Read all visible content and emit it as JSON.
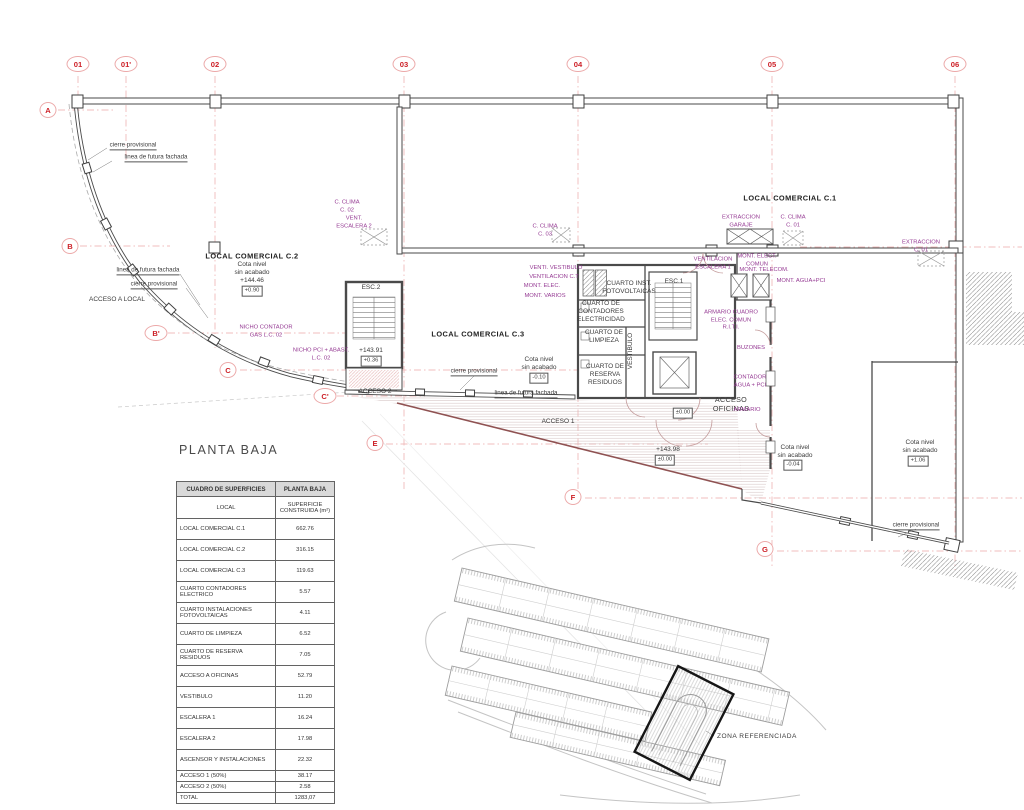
{
  "title": "PLANTA BAJA",
  "colors": {
    "marker_red": "#cd2027",
    "annotation_purple": "#953a93",
    "wall_gray": "#4a4a4a",
    "grid_pink": "#f0bcbc",
    "facade_diagonal": "#8f5252"
  },
  "grid": {
    "top_markers": [
      {
        "label": "01",
        "x": 78,
        "y": 64
      },
      {
        "label": "01'",
        "x": 126,
        "y": 64
      },
      {
        "label": "02",
        "x": 215,
        "y": 64
      },
      {
        "label": "03",
        "x": 404,
        "y": 64
      },
      {
        "label": "04",
        "x": 578,
        "y": 64
      },
      {
        "label": "05",
        "x": 772,
        "y": 64
      },
      {
        "label": "06",
        "x": 955,
        "y": 64
      }
    ],
    "side_markers": [
      {
        "label": "A",
        "x": 48,
        "y": 110
      },
      {
        "label": "B",
        "x": 70,
        "y": 246
      },
      {
        "label": "B'",
        "x": 156,
        "y": 333
      },
      {
        "label": "C",
        "x": 228,
        "y": 370
      },
      {
        "label": "C'",
        "x": 325,
        "y": 396
      },
      {
        "label": "E",
        "x": 375,
        "y": 443
      },
      {
        "label": "F",
        "x": 573,
        "y": 497
      },
      {
        "label": "G",
        "x": 765,
        "y": 549
      }
    ]
  },
  "plan": {
    "labels": [
      {
        "t": "cierre provisional",
        "x": 133,
        "y": 146,
        "k": "u"
      },
      {
        "t": "linea de futura fachada",
        "x": 156,
        "y": 158,
        "k": "u"
      },
      {
        "t": "LOCAL COMERCIAL C.2",
        "x": 252,
        "y": 256,
        "k": "B"
      },
      {
        "t": "Cota nivel\nsin acabado\n+144.46",
        "x": 252,
        "y": 273,
        "k": "b"
      },
      {
        "t": "+0.90",
        "x": 252,
        "y": 291,
        "k": "x"
      },
      {
        "t": "linea de futura fachada",
        "x": 148,
        "y": 271,
        "k": "u"
      },
      {
        "t": "cierre provisional",
        "x": 154,
        "y": 285,
        "k": "u"
      },
      {
        "t": "ACCESO A LOCAL",
        "x": 117,
        "y": 300,
        "k": "b"
      },
      {
        "t": "NICHO CONTADOR\nGAS L.C. 02",
        "x": 266,
        "y": 332,
        "k": "p"
      },
      {
        "t": "NICHO PCI + ABAST.\nL.C. 02",
        "x": 321,
        "y": 355,
        "k": "p"
      },
      {
        "t": "ESC.2",
        "x": 371,
        "y": 288,
        "k": "b"
      },
      {
        "t": "+143.91",
        "x": 371,
        "y": 351,
        "k": "b"
      },
      {
        "t": "+0.36",
        "x": 371,
        "y": 361,
        "k": "x"
      },
      {
        "t": "ACCESO 2",
        "x": 375,
        "y": 392,
        "k": "b"
      },
      {
        "t": "LOCAL COMERCIAL C.3",
        "x": 478,
        "y": 334,
        "k": "B"
      },
      {
        "t": "Cota nivel\nsin acabado",
        "x": 539,
        "y": 364,
        "k": "b"
      },
      {
        "t": "-0.10",
        "x": 539,
        "y": 378,
        "k": "x"
      },
      {
        "t": "cierre provisional",
        "x": 474,
        "y": 372,
        "k": "u"
      },
      {
        "t": "linea de futura fachada",
        "x": 526,
        "y": 394,
        "k": "u"
      },
      {
        "t": "ACCESO 1",
        "x": 558,
        "y": 422,
        "k": "b"
      },
      {
        "t": "+143.98",
        "x": 668,
        "y": 450,
        "k": "b"
      },
      {
        "t": "±0.00",
        "x": 665,
        "y": 460,
        "k": "x"
      },
      {
        "t": "±0.00",
        "x": 683,
        "y": 413,
        "k": "x"
      },
      {
        "t": "C. CLIMA\nC. 02",
        "x": 347,
        "y": 207,
        "k": "p"
      },
      {
        "t": "VENT.\nESCALERA 2",
        "x": 354,
        "y": 223,
        "k": "p"
      },
      {
        "t": "C. CLIMA\nC. 03",
        "x": 545,
        "y": 231,
        "k": "p"
      },
      {
        "t": "VENTI. VESTIBULO",
        "x": 556,
        "y": 269,
        "k": "p"
      },
      {
        "t": "VENTILACION C.T",
        "x": 554,
        "y": 278,
        "k": "p"
      },
      {
        "t": "MONT. ELEC.",
        "x": 542,
        "y": 287,
        "k": "p"
      },
      {
        "t": "MONT. VARIOS",
        "x": 545,
        "y": 297,
        "k": "p"
      },
      {
        "t": "LOCAL COMERCIAL C.1",
        "x": 790,
        "y": 198,
        "k": "B"
      },
      {
        "t": "EXTRACCION\nGARAJE",
        "x": 741,
        "y": 222,
        "k": "p"
      },
      {
        "t": "C. CLIMA\nC. 01",
        "x": 793,
        "y": 222,
        "k": "p"
      },
      {
        "t": "EXTRACCION\nC. 01",
        "x": 921,
        "y": 247,
        "k": "p"
      },
      {
        "t": "VENTILACION\nESCALERA 1",
        "x": 713,
        "y": 264,
        "k": "p"
      },
      {
        "t": "MONT. ELECT.\nCOMUN",
        "x": 757,
        "y": 261,
        "k": "p"
      },
      {
        "t": "MONT. TELECOM.",
        "x": 764,
        "y": 271,
        "k": "p"
      },
      {
        "t": "MONT. AGUA+PCI",
        "x": 801,
        "y": 282,
        "k": "p"
      },
      {
        "t": "CUARTO INST.\nFOTOVOLTAICAS",
        "x": 629,
        "y": 288,
        "k": "b"
      },
      {
        "t": "CUARTO DE\nCONTADORES\nELECTRICIDAD",
        "x": 601,
        "y": 312,
        "k": "b"
      },
      {
        "t": "ESC.1",
        "x": 674,
        "y": 282,
        "k": "b"
      },
      {
        "t": "CUARTO DE\nLIMPIEZA",
        "x": 604,
        "y": 337,
        "k": "b"
      },
      {
        "t": "VESTIBULO",
        "x": 631,
        "y": 351,
        "k": "v"
      },
      {
        "t": "CUARTO DE\nRESERVA\nRESIDUOS",
        "x": 605,
        "y": 375,
        "k": "b"
      },
      {
        "t": "ARMARIO CUADRO\nELEC. COMUN\nR.I.T.I.",
        "x": 731,
        "y": 321,
        "k": "p"
      },
      {
        "t": "BUZONES",
        "x": 751,
        "y": 349,
        "k": "p"
      },
      {
        "t": "CONTADOR\nAGUA + PCI",
        "x": 750,
        "y": 382,
        "k": "p"
      },
      {
        "t": "ACCESO\nOFICINAS",
        "x": 731,
        "y": 404,
        "k": "a"
      },
      {
        "t": "ARMARIO",
        "x": 747,
        "y": 411,
        "k": "p"
      },
      {
        "t": "Cota nivel\nsin acabado",
        "x": 795,
        "y": 452,
        "k": "b"
      },
      {
        "t": "-0.04",
        "x": 793,
        "y": 465,
        "k": "x"
      },
      {
        "t": "Cota nivel\nsin acabado",
        "x": 920,
        "y": 447,
        "k": "b"
      },
      {
        "t": "+1.06",
        "x": 918,
        "y": 461,
        "k": "x"
      },
      {
        "t": "cierre provisional",
        "x": 916,
        "y": 526,
        "k": "u"
      }
    ]
  },
  "table": {
    "header": [
      "CUADRO DE SUPERFICIES",
      "PLANTA BAJA"
    ],
    "subheader": [
      "LOCAL",
      "SUPERFICIE CONSTRUIDA (m²)"
    ],
    "rows": [
      {
        "n": "LOCAL COMERCIAL C.1",
        "v": "662.76"
      },
      {
        "n": "LOCAL COMERCIAL C.2",
        "v": "316.15"
      },
      {
        "n": "LOCAL COMERCIAL C.3",
        "v": "119.63"
      },
      {
        "n": "CUARTO CONTADORES ELECTRICO",
        "v": "5.57"
      },
      {
        "n": "CUARTO INSTALACIONES FOTOVOLTAICAS",
        "v": "4.11"
      },
      {
        "n": "CUARTO DE LIMPIEZA",
        "v": "6.52"
      },
      {
        "n": "CUARTO DE RESERVA RESIDUOS",
        "v": "7.05"
      },
      {
        "n": "ACCESO A OFICINAS",
        "v": "52.79"
      },
      {
        "n": "VESTIBULO",
        "v": "11.20"
      },
      {
        "n": "ESCALERA 1",
        "v": "16.24"
      },
      {
        "n": "ESCALERA 2",
        "v": "17.98"
      },
      {
        "n": "ASCENSOR Y INSTALACIONES",
        "v": "22.32"
      },
      {
        "n": "ACCESO 1  (50%)",
        "v": "38.17",
        "s": true
      },
      {
        "n": "ACCESO 2  (50%)",
        "v": "2.58",
        "s": true
      },
      {
        "n": "TOTAL",
        "v": "1283,07",
        "s": true
      }
    ]
  },
  "site_map": {
    "caption": "ZONA REFERENCIADA"
  }
}
